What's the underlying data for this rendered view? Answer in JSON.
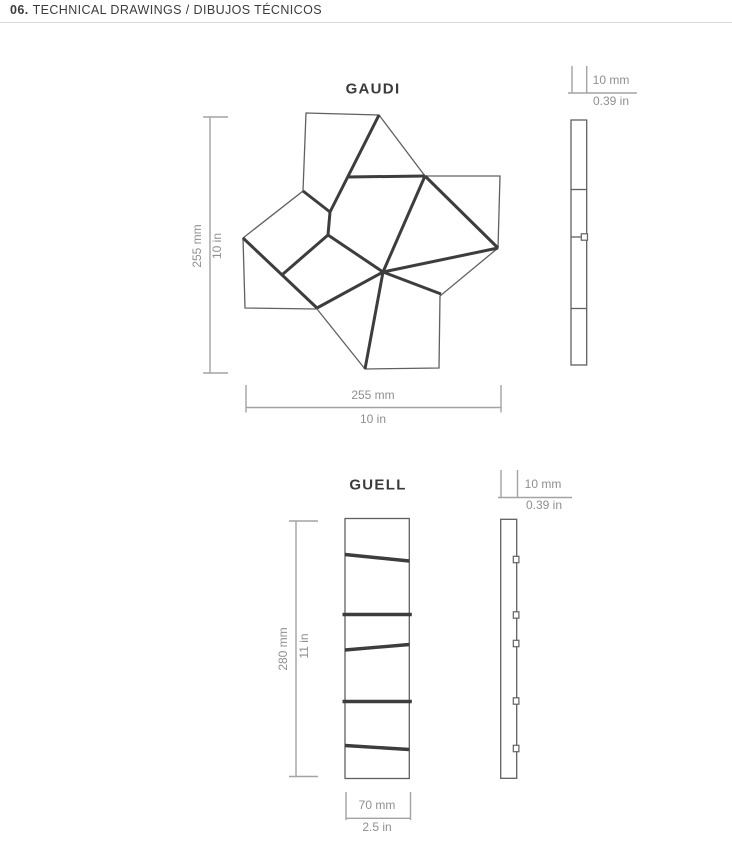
{
  "header": {
    "number": "06.",
    "title": "TECHNICAL DRAWINGS / DIBUJOS TÉCNICOS"
  },
  "colors": {
    "ink": "#3b3b3b",
    "line_thick": "#3d3d3d",
    "line_thin": "#606060",
    "dim_line": "#a3a3a3",
    "dim_text": "#8f8f8f",
    "rule": "#d9d9d9"
  },
  "gaudi": {
    "title": "GAUDI",
    "height_mm": "255 mm",
    "height_in": "10 in",
    "width_mm": "255 mm",
    "width_in": "10 in",
    "thickness_mm": "10 mm",
    "thickness_in": "0.39 in"
  },
  "guell": {
    "title": "GUELL",
    "height_mm": "280 mm",
    "height_in": "11 in",
    "width_mm": "70 mm",
    "width_in": "2.5 in",
    "thickness_mm": "10 mm",
    "thickness_in": "0.39 in"
  }
}
